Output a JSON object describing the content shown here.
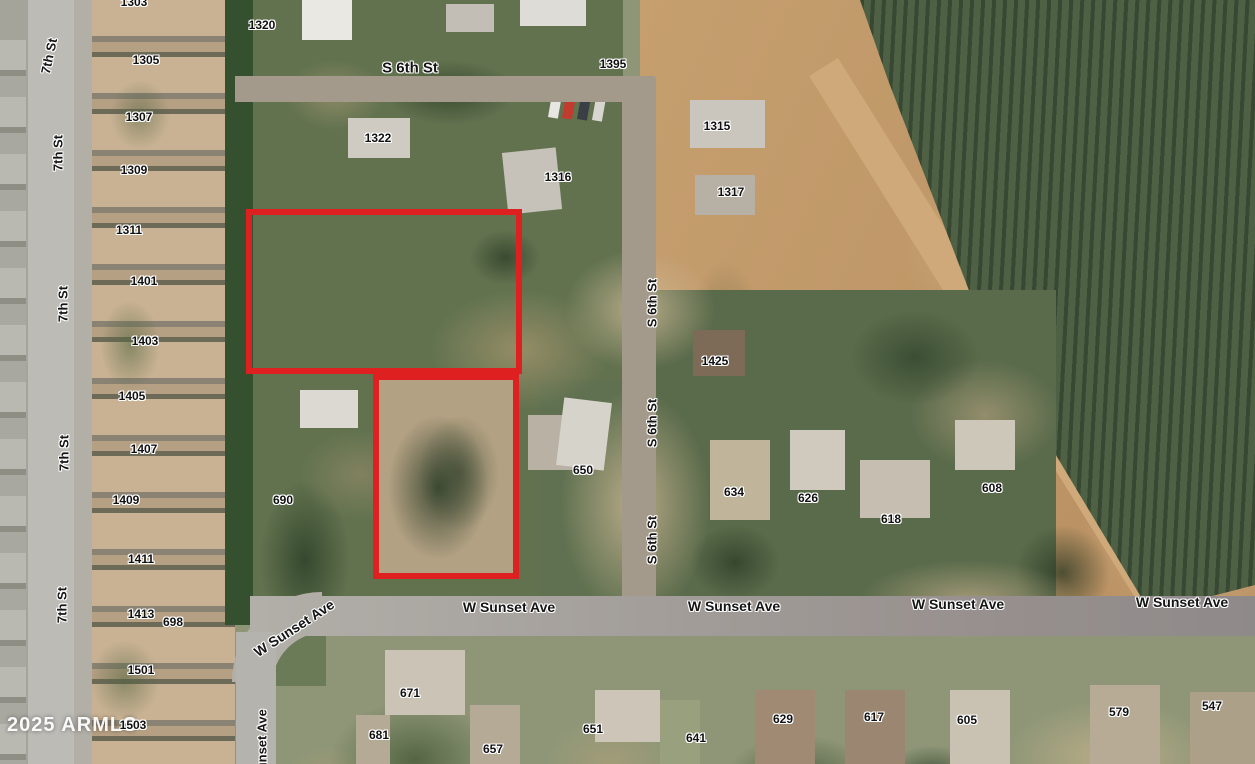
{
  "watermark": "2025 ARMLS",
  "colors": {
    "parcel_outline": "#de2020",
    "label_text": "#141414",
    "label_halo": "#ffffff",
    "watermark_text": "#ffffff"
  },
  "street_labels": [
    {
      "text": "7th St",
      "x": 49,
      "y": 56,
      "rot": -78,
      "fs": 13
    },
    {
      "text": "7th St",
      "x": 58,
      "y": 153,
      "rot": -90,
      "fs": 13
    },
    {
      "text": "7th St",
      "x": 63,
      "y": 304,
      "rot": -90,
      "fs": 13
    },
    {
      "text": "7th St",
      "x": 64,
      "y": 453,
      "rot": -90,
      "fs": 13
    },
    {
      "text": "7th St",
      "x": 62,
      "y": 605,
      "rot": -90,
      "fs": 13
    },
    {
      "text": "S 6th St",
      "x": 410,
      "y": 68,
      "rot": 0,
      "fs": 15
    },
    {
      "text": "S 6th St",
      "x": 652,
      "y": 303,
      "rot": -90,
      "fs": 13
    },
    {
      "text": "S 6th St",
      "x": 652,
      "y": 423,
      "rot": -90,
      "fs": 13
    },
    {
      "text": "S 6th St",
      "x": 652,
      "y": 540,
      "rot": -90,
      "fs": 13
    },
    {
      "text": "W Sunset Ave",
      "x": 294,
      "y": 628,
      "rot": -33,
      "fs": 14
    },
    {
      "text": "W Sunset Ave",
      "x": 509,
      "y": 607,
      "rot": 0,
      "fs": 14
    },
    {
      "text": "W Sunset Ave",
      "x": 734,
      "y": 606,
      "rot": 0,
      "fs": 14
    },
    {
      "text": "W Sunset Ave",
      "x": 958,
      "y": 604,
      "rot": 0,
      "fs": 14
    },
    {
      "text": "W Sunset Ave",
      "x": 1182,
      "y": 602,
      "rot": 0,
      "fs": 14
    },
    {
      "text": "W Sunset Ave",
      "x": 262,
      "y": 752,
      "rot": -90,
      "fs": 13
    }
  ],
  "parcel_number_labels": [
    {
      "text": "1303",
      "x": 134,
      "y": 2
    },
    {
      "text": "1305",
      "x": 146,
      "y": 60
    },
    {
      "text": "1307",
      "x": 139,
      "y": 117
    },
    {
      "text": "1309",
      "x": 134,
      "y": 170
    },
    {
      "text": "1311",
      "x": 129,
      "y": 230
    },
    {
      "text": "1320",
      "x": 262,
      "y": 25
    },
    {
      "text": "1322",
      "x": 378,
      "y": 138
    },
    {
      "text": "1395",
      "x": 613,
      "y": 64
    },
    {
      "text": "1316",
      "x": 558,
      "y": 177
    },
    {
      "text": "1315",
      "x": 717,
      "y": 126
    },
    {
      "text": "1317",
      "x": 731,
      "y": 192
    },
    {
      "text": "1401",
      "x": 144,
      "y": 281
    },
    {
      "text": "1403",
      "x": 145,
      "y": 341
    },
    {
      "text": "1405",
      "x": 132,
      "y": 396
    },
    {
      "text": "1407",
      "x": 144,
      "y": 449
    },
    {
      "text": "1409",
      "x": 126,
      "y": 500
    },
    {
      "text": "1411",
      "x": 141,
      "y": 559
    },
    {
      "text": "1413",
      "x": 141,
      "y": 614
    },
    {
      "text": "698",
      "x": 173,
      "y": 622
    },
    {
      "text": "1501",
      "x": 141,
      "y": 670
    },
    {
      "text": "1503",
      "x": 133,
      "y": 725
    },
    {
      "text": "1425",
      "x": 715,
      "y": 361
    },
    {
      "text": "650",
      "x": 583,
      "y": 470
    },
    {
      "text": "690",
      "x": 283,
      "y": 500
    },
    {
      "text": "634",
      "x": 734,
      "y": 492
    },
    {
      "text": "626",
      "x": 808,
      "y": 498
    },
    {
      "text": "618",
      "x": 891,
      "y": 519
    },
    {
      "text": "608",
      "x": 992,
      "y": 488
    },
    {
      "text": "671",
      "x": 410,
      "y": 693
    },
    {
      "text": "681",
      "x": 379,
      "y": 735
    },
    {
      "text": "657",
      "x": 493,
      "y": 749
    },
    {
      "text": "651",
      "x": 593,
      "y": 729
    },
    {
      "text": "641",
      "x": 696,
      "y": 738
    },
    {
      "text": "629",
      "x": 783,
      "y": 719
    },
    {
      "text": "617",
      "x": 874,
      "y": 717
    },
    {
      "text": "605",
      "x": 967,
      "y": 720
    },
    {
      "text": "579",
      "x": 1119,
      "y": 712
    },
    {
      "text": "547",
      "x": 1212,
      "y": 706
    }
  ],
  "outlined_parcels": [
    {
      "x": 246,
      "y": 209,
      "w": 276,
      "h": 165
    },
    {
      "x": 373,
      "y": 374,
      "w": 146,
      "h": 205
    }
  ]
}
